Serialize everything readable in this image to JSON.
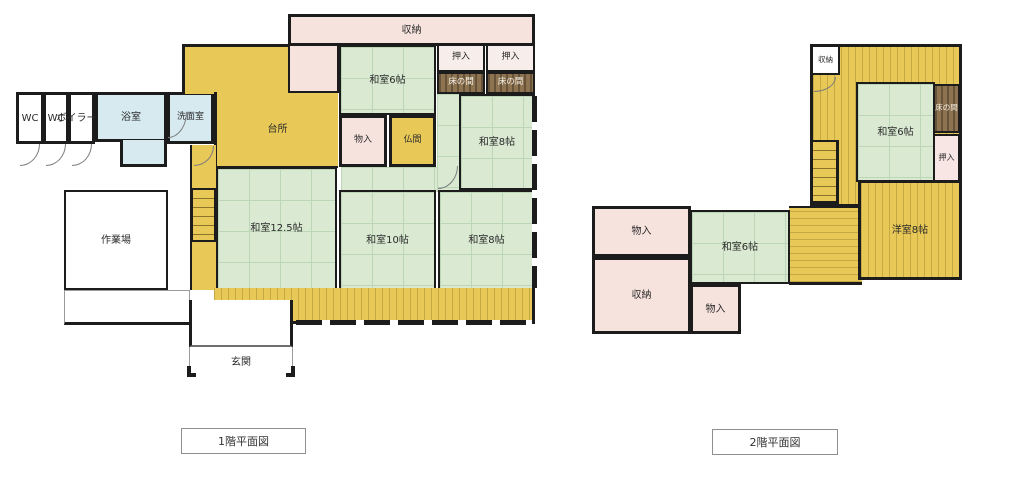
{
  "floor1": {
    "caption": "1階平面図",
    "rooms": {
      "wc1": "WC",
      "wc2": "WC",
      "boiler": "ボイラー室",
      "bath": "浴室",
      "washroom": "洗面室",
      "kitchen": "台所",
      "storage": "収納",
      "washitsu6": "和室6帖",
      "oshiire1": "押入",
      "oshiire2": "押入",
      "tokonoma1": "床の間",
      "tokonoma2": "床の間",
      "monoire": "物入",
      "butsuma": "仏間",
      "washitsu8_top": "和室8帖",
      "washitsu125": "和室12.5帖",
      "washitsu10": "和室10帖",
      "washitsu8_bottom": "和室8帖",
      "workshop": "作業場",
      "genkan": "玄関"
    }
  },
  "floor2": {
    "caption": "2階平面図",
    "rooms": {
      "storage_top": "収納",
      "washitsu6_top": "和室6帖",
      "tokonoma": "床の間",
      "oshiire": "押入",
      "monoire_upper": "物入",
      "washitsu6": "和室6帖",
      "yoshitsu8": "洋室8帖",
      "storage": "収納",
      "monoire_lower": "物入"
    }
  },
  "colors": {
    "tatami_green": "#d9e9d2",
    "wood_yellow": "#e8c957",
    "closet_pink": "#f7e3de",
    "tokonoma_brown": "#8d7350",
    "water_blue": "#d6eaf0",
    "wall_black": "#1c1c1c"
  }
}
